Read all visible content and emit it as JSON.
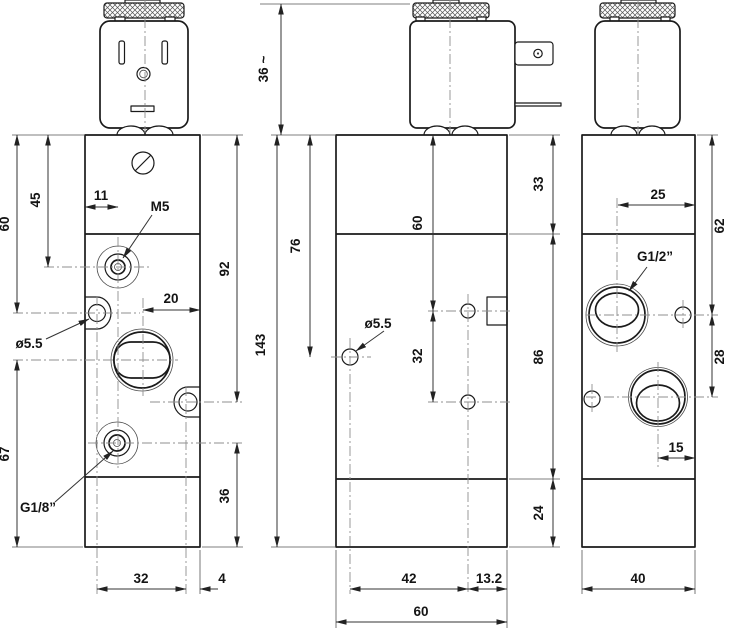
{
  "front": {
    "labels": {
      "h60": "60",
      "h45": "45",
      "w11": "11",
      "m5": "M5",
      "h92": "92",
      "w20": "20",
      "dia55": "ø5.5",
      "h67": "67",
      "g18": "G1/8”",
      "h36": "36",
      "w32": "32",
      "w4": "4"
    }
  },
  "side": {
    "labels": {
      "h36t": "36 ~",
      "h143": "143",
      "h76": "76",
      "v60": "60",
      "h33": "33",
      "dia55": "ø5.5",
      "v32": "32",
      "h86": "86",
      "h24": "24",
      "w42": "42",
      "w132": "13.2",
      "w60": "60"
    }
  },
  "back": {
    "labels": {
      "w25": "25",
      "h62": "62",
      "g12": "G1/2”",
      "h28": "28",
      "w15": "15",
      "w40": "40"
    }
  }
}
